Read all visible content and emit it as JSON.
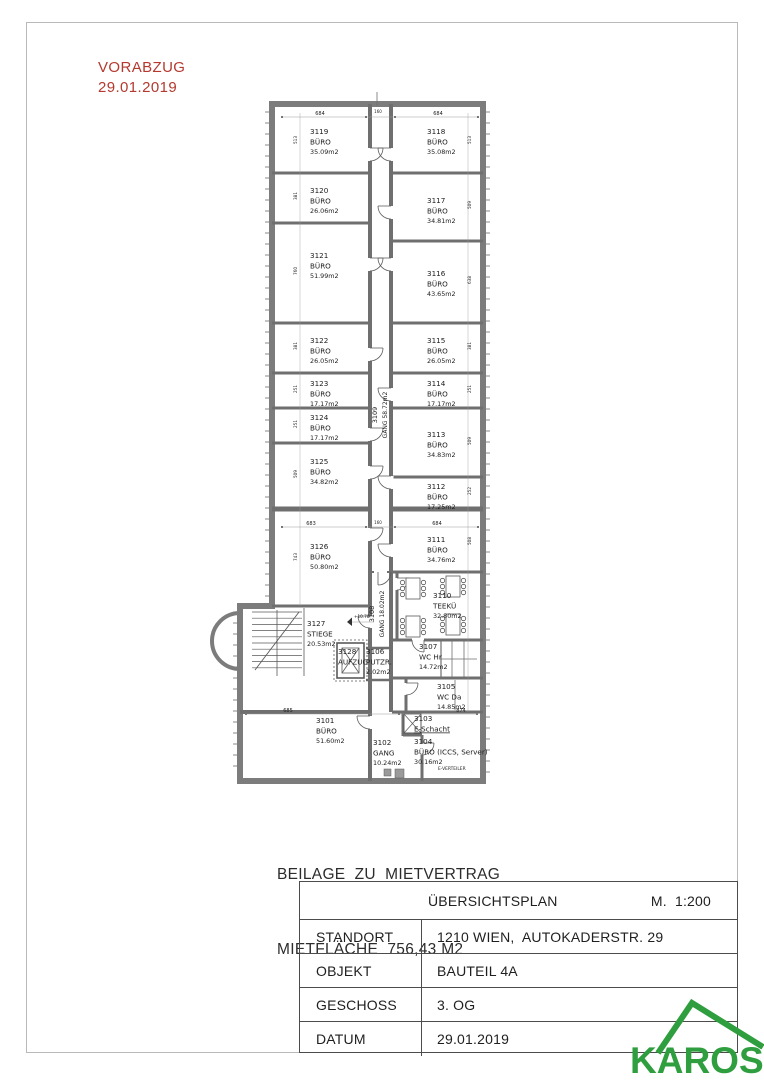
{
  "stamp": {
    "line1": "VORABZUG",
    "line2": "29.01.2019"
  },
  "notes": {
    "line1": "BEILAGE  ZU  MIETVERTRAG",
    "line2": "MIETFLÄCHE  756,43 M2"
  },
  "titleblock": {
    "title": "ÜBERSICHTSPLAN",
    "scale": "M.  1:200",
    "rows": [
      {
        "label": "STANDORT",
        "value": "1210 WIEN,  AUTOKADERSTR. 29"
      },
      {
        "label": "OBJEKT",
        "value": "BAUTEIL 4A"
      },
      {
        "label": "GESCHOSS",
        "value": "3. OG"
      },
      {
        "label": "DATUM",
        "value": "29.01.2019"
      }
    ]
  },
  "logo": {
    "text": "KAROS"
  },
  "colors": {
    "stamp_red": "#b4392f",
    "logo_green": "#2f9e3e",
    "wall": "#7c7c7c",
    "line": "#5a5a5a"
  },
  "plan": {
    "rooms": [
      {
        "id": "3119",
        "type": "BÜRO",
        "area": "35.09m2",
        "x": 310,
        "y": 134
      },
      {
        "id": "3120",
        "type": "BÜRO",
        "area": "26.06m2",
        "x": 310,
        "y": 193
      },
      {
        "id": "3121",
        "type": "BÜRO",
        "area": "51.99m2",
        "x": 310,
        "y": 258
      },
      {
        "id": "3122",
        "type": "BÜRO",
        "area": "26.05m2",
        "x": 310,
        "y": 343
      },
      {
        "id": "3123",
        "type": "BÜRO",
        "area": "17.17m2",
        "x": 310,
        "y": 386
      },
      {
        "id": "3124",
        "type": "BÜRO",
        "area": "17.17m2",
        "x": 310,
        "y": 420
      },
      {
        "id": "3125",
        "type": "BÜRO",
        "area": "34.82m2",
        "x": 310,
        "y": 464
      },
      {
        "id": "3126",
        "type": "BÜRO",
        "area": "50.80m2",
        "x": 310,
        "y": 549
      },
      {
        "id": "3127",
        "type": "STIEGE",
        "area": "20.53m2",
        "x": 307,
        "y": 626
      },
      {
        "id": "3128",
        "type": "AUFZUG",
        "area": "",
        "x": 338,
        "y": 654
      },
      {
        "id": "3101",
        "type": "BÜRO",
        "area": "51.60m2",
        "x": 316,
        "y": 723
      },
      {
        "id": "3102",
        "type": "GANG",
        "area": "10.24m2",
        "x": 373,
        "y": 745
      },
      {
        "id": "3106",
        "type": "PUTZR.",
        "area": "2.02m2",
        "x": 366,
        "y": 654
      },
      {
        "id": "3109",
        "type": "GANG",
        "area": "58.72m2",
        "x": 380,
        "y": 415,
        "rot": -90
      },
      {
        "id": "3108",
        "type": "GANG",
        "area": "18.02m2",
        "x": 377,
        "y": 614,
        "rot": -90
      },
      {
        "id": "3118",
        "type": "BÜRO",
        "area": "35.08m2",
        "x": 427,
        "y": 134
      },
      {
        "id": "3117",
        "type": "BÜRO",
        "area": "34.81m2",
        "x": 427,
        "y": 203
      },
      {
        "id": "3116",
        "type": "BÜRO",
        "area": "43.65m2",
        "x": 427,
        "y": 276
      },
      {
        "id": "3115",
        "type": "BÜRO",
        "area": "26.05m2",
        "x": 427,
        "y": 343
      },
      {
        "id": "3114",
        "type": "BÜRO",
        "area": "17.17m2",
        "x": 427,
        "y": 386
      },
      {
        "id": "3113",
        "type": "BÜRO",
        "area": "34.83m2",
        "x": 427,
        "y": 437
      },
      {
        "id": "3112",
        "type": "BÜRO",
        "area": "17.25m2",
        "x": 427,
        "y": 489
      },
      {
        "id": "3111",
        "type": "BÜRO",
        "area": "34.76m2",
        "x": 427,
        "y": 542
      },
      {
        "id": "3110",
        "type": "TEEKÜ",
        "area": "32.80m2",
        "x": 433,
        "y": 598
      },
      {
        "id": "3107",
        "type": "WC Hr",
        "area": "14.72m2",
        "x": 419,
        "y": 649
      },
      {
        "id": "3105",
        "type": "WC Da",
        "area": "14.85m2",
        "x": 437,
        "y": 689
      },
      {
        "id": "3103",
        "type": "E-Schacht",
        "area": "",
        "x": 414,
        "y": 721,
        "underline": true
      },
      {
        "id": "3104",
        "type": "BÜRO (ICCS, Server)",
        "area": "30.16m2",
        "x": 414,
        "y": 744
      }
    ],
    "dims": [
      {
        "t": "684",
        "x": 320,
        "y": 115
      },
      {
        "t": "160",
        "x": 378,
        "y": 113,
        "f": 4
      },
      {
        "t": "684",
        "x": 438,
        "y": 115
      },
      {
        "t": "683",
        "x": 311,
        "y": 525
      },
      {
        "t": "160",
        "x": 378,
        "y": 524,
        "f": 4
      },
      {
        "t": "684",
        "x": 437,
        "y": 525
      },
      {
        "t": "685",
        "x": 288,
        "y": 712
      },
      {
        "t": "874",
        "x": 461,
        "y": 712
      }
    ],
    "side_dims": [
      {
        "t": "513",
        "x": 297,
        "y": 140
      },
      {
        "t": "381",
        "x": 297,
        "y": 196
      },
      {
        "t": "760",
        "x": 297,
        "y": 271
      },
      {
        "t": "381",
        "x": 297,
        "y": 346
      },
      {
        "t": "251",
        "x": 297,
        "y": 389
      },
      {
        "t": "251",
        "x": 297,
        "y": 424
      },
      {
        "t": "509",
        "x": 297,
        "y": 474
      },
      {
        "t": "743",
        "x": 297,
        "y": 557
      },
      {
        "t": "513",
        "x": 471,
        "y": 140
      },
      {
        "t": "509",
        "x": 471,
        "y": 205
      },
      {
        "t": "638",
        "x": 471,
        "y": 280
      },
      {
        "t": "381",
        "x": 471,
        "y": 346
      },
      {
        "t": "251",
        "x": 471,
        "y": 389
      },
      {
        "t": "509",
        "x": 471,
        "y": 441
      },
      {
        "t": "252",
        "x": 471,
        "y": 491
      },
      {
        "t": "508",
        "x": 471,
        "y": 541
      }
    ],
    "extras": [
      {
        "t": "E-VERTEILER",
        "x": 438,
        "y": 770,
        "f": 4.4
      },
      {
        "t": "+10.78",
        "x": 354,
        "y": 618,
        "f": 4.2
      }
    ]
  }
}
